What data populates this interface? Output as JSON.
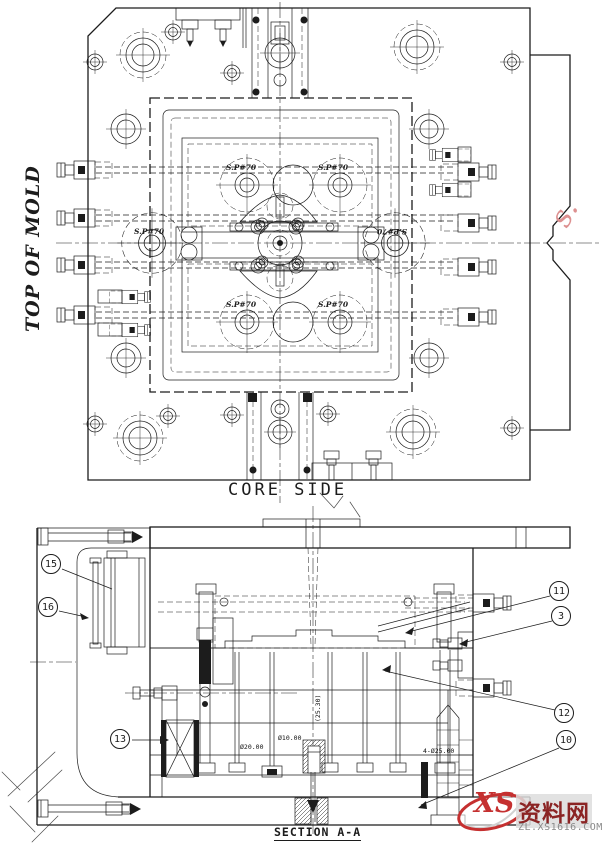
{
  "top_view": {
    "side_label": "TOP OF MOLD",
    "bottom_label": "CORE SIDE",
    "spring_labels": [
      "S.P#70",
      "S.P#70",
      "S.P#70",
      "S.P#70",
      "S.P#70",
      "S.P#70"
    ]
  },
  "section_view": {
    "title": "SECTION A-A",
    "balloons": [
      "15",
      "16",
      "13",
      "11",
      "3",
      "12",
      "10"
    ],
    "dimensions": [
      "Ø20.00",
      "Ø10.00",
      "(25.30)",
      "4-Ø25.00"
    ]
  },
  "watermark": {
    "diagonal_fragment": "s.",
    "logo_text": "XS",
    "site_name": "资料网",
    "site_url": "ZL.XS1616.COM"
  },
  "colors": {
    "line": "#1c1c1c",
    "watermark_red": "#e09191",
    "logo_red": "#c53030",
    "site_name_red": "#8b2424",
    "url_gray": "#8a8a8a"
  }
}
